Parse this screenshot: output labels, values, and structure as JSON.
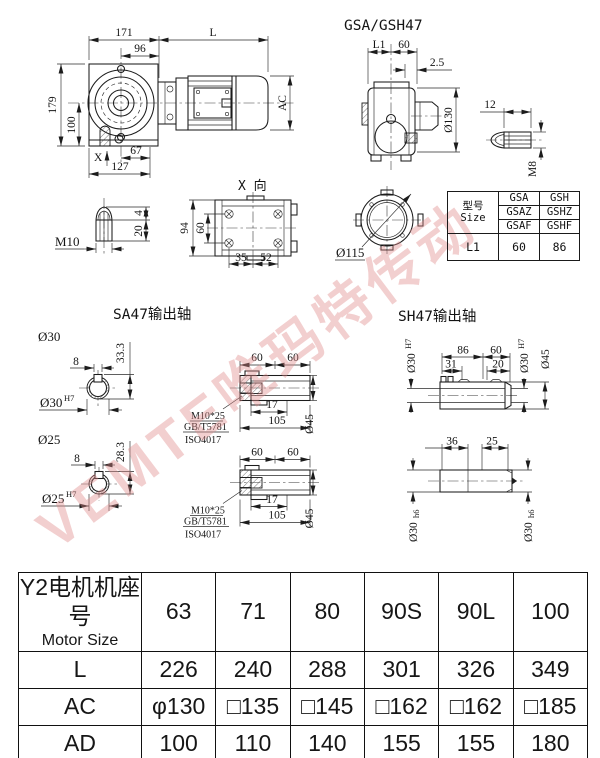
{
  "colors": {
    "line": "#1c1c1c",
    "watermark": "#e08a8a",
    "background": "#ffffff"
  },
  "watermark": {
    "text": "VEMTE唯玛特传动"
  },
  "front_view": {
    "d171": "171",
    "d96": "96",
    "dL": "L",
    "d179": "179",
    "d100": "100",
    "dAC": "AC",
    "d67": "67",
    "d127": "127",
    "x_label": "X"
  },
  "side_view": {
    "title": "GSA/GSH47",
    "dL1": "L1",
    "d60": "60",
    "d2_5": "2.5",
    "d130": "Ø130",
    "d12": "12",
    "dM8": "M8"
  },
  "m10_detail": {
    "label": "M10",
    "d4": "4",
    "d20": "20"
  },
  "x_view": {
    "label": "X 向",
    "d94": "94",
    "d60": "60",
    "d35": "35",
    "d52": "52"
  },
  "flange_view": {
    "d115": "Ø115"
  },
  "size_table": {
    "model_cn": "型号",
    "model_en": "Size",
    "col_a": [
      "GSA",
      "GSAZ",
      "GSAF"
    ],
    "col_b": [
      "GSH",
      "GSHZ",
      "GSHF"
    ],
    "l1": "L1",
    "l1_a": "60",
    "l1_b": "86"
  },
  "sa47": {
    "title": "SA47输出轴",
    "d30": "Ø30",
    "d25": "Ø25",
    "h7": "H7",
    "d8": "8",
    "d33_3": "33.3",
    "d28_3": "28.3",
    "d60": "60",
    "d17": "17",
    "d105": "105",
    "d45": "Ø45",
    "note1": "M10*25",
    "note2": "GB/T5781",
    "note3": "ISO4017"
  },
  "sh47": {
    "title": "SH47输出轴",
    "d30": "Ø30",
    "h7": "H7",
    "h6": "h6",
    "d86": "86",
    "d60": "60",
    "d31": "31",
    "d20": "20",
    "d45": "Ø45",
    "d36": "36",
    "d25": "25"
  },
  "motor_table": {
    "header_cn": "Y2电机机座号",
    "header_en": "Motor Size",
    "sizes": [
      "63",
      "71",
      "80",
      "90S",
      "90L",
      "100"
    ],
    "rows": [
      {
        "label": "L",
        "values": [
          "226",
          "240",
          "288",
          "301",
          "326",
          "349"
        ]
      },
      {
        "label": "AC",
        "values": [
          "φ130",
          "□135",
          "□145",
          "□162",
          "□162",
          "□185"
        ]
      },
      {
        "label": "AD",
        "values": [
          "100",
          "110",
          "140",
          "155",
          "155",
          "180"
        ]
      }
    ]
  }
}
